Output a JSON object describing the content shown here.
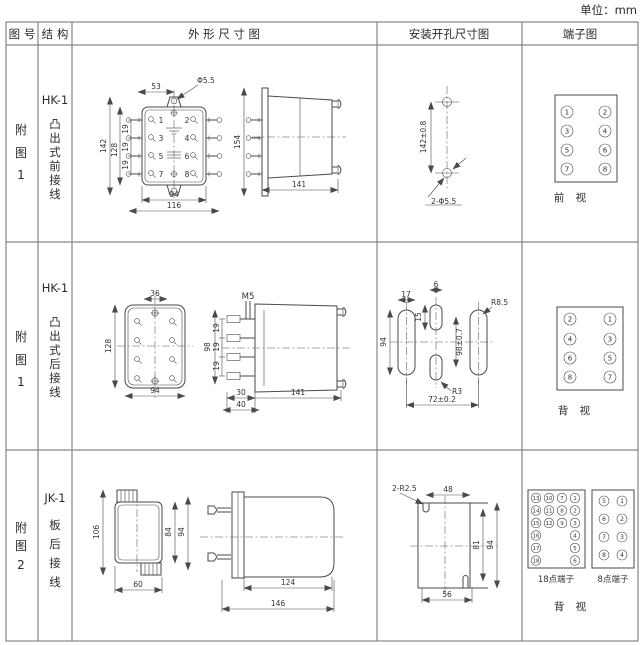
{
  "page": {
    "unit_label": "单位：mm"
  },
  "header": {
    "fig_no": "图 号",
    "structure": "结 构",
    "outline": "外 形 尺 寸 图",
    "mounting": "安装开孔尺寸图",
    "terminal": "端子图"
  },
  "row1": {
    "fig": {
      "l1": "附",
      "l2": "图",
      "l3": "1"
    },
    "model": "HK-1",
    "desc": [
      "凸",
      "出",
      "式",
      "前",
      "接",
      "线"
    ],
    "outline": {
      "d53": "53",
      "dphi": "Φ5.5",
      "d142": "142",
      "d128": "128",
      "d19a": "19",
      "d19b": "19",
      "d19c": "19",
      "n1": "1",
      "n2": "2",
      "n3": "3",
      "n4": "4",
      "n5": "5",
      "n6": "6",
      "n7": "7",
      "n8": "8",
      "d94": "94",
      "d116": "116",
      "d154": "154",
      "d141": "141"
    },
    "mounting": {
      "dv": "142±0.8",
      "dh": "2-Φ5.5"
    },
    "terminal": {
      "nums_left": [
        "1",
        "3",
        "5",
        "7"
      ],
      "nums_right": [
        "2",
        "4",
        "6",
        "8"
      ],
      "view": "前 视"
    }
  },
  "row2": {
    "fig": {
      "l1": "附",
      "l2": "图",
      "l3": "1"
    },
    "model": "HK-1",
    "desc": [
      "凸",
      "出",
      "式",
      "后",
      "接",
      "线"
    ],
    "outline": {
      "d36": "36",
      "d128": "128",
      "d94": "94",
      "m5": "M5",
      "d98": "98",
      "d19a": "19",
      "d19b": "19",
      "d19c": "19",
      "d30": "30",
      "d40": "40",
      "d141": "141"
    },
    "mounting": {
      "d17": "17",
      "d6": "6",
      "d15": "15",
      "d94": "94",
      "d98": "98±0.7",
      "r85": "R8.5",
      "r3": "R3",
      "d72": "72±0.2"
    },
    "terminal": {
      "nums_left": [
        "2",
        "4",
        "6",
        "8"
      ],
      "nums_right": [
        "1",
        "3",
        "5",
        "7"
      ],
      "view": "背 视"
    }
  },
  "row3": {
    "fig": {
      "l1": "附",
      "l2": "图",
      "l3": "2"
    },
    "model": "JK-1",
    "desc": [
      "板",
      "后",
      "接",
      "线"
    ],
    "outline": {
      "d106": "106",
      "d84": "84",
      "d94": "94",
      "d60": "60",
      "d124": "124",
      "d146": "146"
    },
    "mounting": {
      "r25": "2-R2.5",
      "d48": "48",
      "d81": "81",
      "d94": "94",
      "d56": "56"
    },
    "terminal": {
      "t18": {
        "label": "18点端子",
        "rows": [
          [
            "13",
            "10",
            "7",
            "1"
          ],
          [
            "14",
            "11",
            "8",
            "2"
          ],
          [
            "15",
            "12",
            "9",
            "3"
          ],
          [
            "16",
            "4"
          ],
          [
            "17",
            "5"
          ],
          [
            "18",
            "6"
          ]
        ]
      },
      "t8": {
        "label": "8点端子",
        "left": [
          "5",
          "6",
          "7",
          "8"
        ],
        "right": [
          "1",
          "2",
          "3",
          "4"
        ]
      },
      "view": "背 视"
    }
  }
}
